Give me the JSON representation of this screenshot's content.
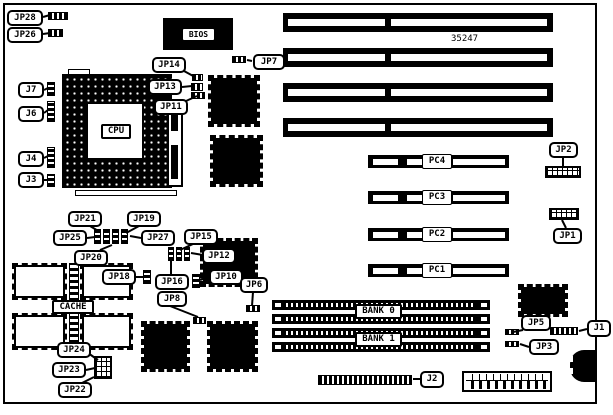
{
  "part_number": {
    "text": "35247"
  },
  "colors": {
    "ink": "#000000",
    "paper": "#ffffff"
  },
  "board": {
    "x": 3,
    "y": 3,
    "w": 594,
    "h": 401
  },
  "cpu": {
    "socket": {
      "x": 62,
      "y": 74,
      "w": 110,
      "h": 114
    },
    "inner": {
      "x": 86,
      "y": 102,
      "w": 58,
      "h": 58
    },
    "lever": {
      "x": 75,
      "y": 190,
      "w": 102,
      "h": 6
    },
    "notch": {
      "x": 68,
      "y": 69,
      "w": 22,
      "h": 6
    },
    "vreg": {
      "x": 167,
      "y": 103,
      "w": 16,
      "h": 84,
      "bar": {
        "x": 171,
        "y": 111,
        "w": 7,
        "h": 68
      },
      "gap": {
        "x": 171,
        "y": 131,
        "w": 7,
        "h": 14
      }
    }
  },
  "bios_chip": {
    "x": 163,
    "y": 18,
    "w": 70,
    "h": 32
  },
  "isa_slots": {
    "x": 283,
    "w": 270,
    "h": 19,
    "tops": [
      13,
      48,
      83,
      118
    ],
    "segs": [
      [
        5,
        97
      ],
      [
        108,
        156
      ]
    ],
    "segY": 6,
    "segH": 7
  },
  "pc_slots": {
    "x": 368,
    "w": 141,
    "h": 13,
    "items": [
      {
        "label": "PC4",
        "top": 155
      },
      {
        "label": "PC3",
        "top": 191
      },
      {
        "label": "PC2",
        "top": 228
      },
      {
        "label": "PC1",
        "top": 264
      }
    ],
    "segs": [
      [
        5,
        25
      ],
      [
        39,
        16
      ],
      [
        85,
        52
      ]
    ],
    "segY": 4,
    "segH": 6,
    "label_dx": 54,
    "label_w": 30,
    "label_h": 15
  },
  "simm_slots": {
    "x": 272,
    "w": 218,
    "h": 10,
    "tops": [
      300,
      314,
      328,
      342
    ]
  },
  "qfp_chips": [
    {
      "id": "qfp-chip-1",
      "x": 208,
      "y": 75,
      "w": 52,
      "h": 52
    },
    {
      "id": "qfp-chip-2",
      "x": 210,
      "y": 135,
      "w": 53,
      "h": 52
    },
    {
      "id": "qfp-chip-3",
      "x": 200,
      "y": 238,
      "w": 58,
      "h": 49
    },
    {
      "id": "qfp-chip-4",
      "x": 141,
      "y": 321,
      "w": 49,
      "h": 51
    },
    {
      "id": "qfp-chip-5",
      "x": 207,
      "y": 321,
      "w": 51,
      "h": 51
    },
    {
      "id": "qfp-chip-6",
      "x": 518,
      "y": 284,
      "w": 50,
      "h": 33
    }
  ],
  "cache": {
    "chips": [
      {
        "x": 12,
        "y": 263,
        "w": 55,
        "h": 37
      },
      {
        "x": 80,
        "y": 263,
        "w": 53,
        "h": 37
      },
      {
        "x": 12,
        "y": 313,
        "w": 55,
        "h": 37
      },
      {
        "x": 80,
        "y": 313,
        "w": 53,
        "h": 37
      }
    ],
    "pack": {
      "x": 69,
      "y": 263,
      "w": 10,
      "h": 87
    }
  },
  "power_connector": {
    "x": 462,
    "y": 371,
    "w": 90,
    "h": 21
  },
  "keyboard_connector": {
    "x": 570,
    "y": 350,
    "w": 27,
    "h": 32,
    "notches": [
      [
        568,
        356,
        5,
        6
      ],
      [
        568,
        368,
        5,
        6
      ]
    ]
  },
  "connectors": [
    {
      "id": "jp28-connector",
      "x": 48,
      "y": 12,
      "w": 20,
      "h": 8,
      "type": "h"
    },
    {
      "id": "jp26-connector",
      "x": 48,
      "y": 29,
      "w": 15,
      "h": 8,
      "type": "h"
    },
    {
      "id": "j7-connector",
      "x": 47,
      "y": 82,
      "w": 8,
      "h": 14,
      "type": "v"
    },
    {
      "id": "j6-connector",
      "x": 47,
      "y": 101,
      "w": 8,
      "h": 21,
      "type": "v"
    },
    {
      "id": "j4-connector",
      "x": 47,
      "y": 147,
      "w": 8,
      "h": 21,
      "type": "v"
    },
    {
      "id": "j3-connector",
      "x": 47,
      "y": 174,
      "w": 8,
      "h": 13,
      "type": "v"
    },
    {
      "id": "jp14-jumper",
      "x": 192,
      "y": 74,
      "w": 11,
      "h": 7,
      "type": "h"
    },
    {
      "id": "jp13-jumper",
      "x": 191,
      "y": 83,
      "w": 12,
      "h": 8,
      "type": "h"
    },
    {
      "id": "jp11-jumper",
      "x": 191,
      "y": 92,
      "w": 14,
      "h": 7,
      "type": "h"
    },
    {
      "id": "jp7-connector",
      "x": 232,
      "y": 56,
      "w": 14,
      "h": 7,
      "type": "h"
    },
    {
      "id": "jumper-cluster-a1",
      "x": 94,
      "y": 229,
      "w": 7,
      "h": 15,
      "type": "v"
    },
    {
      "id": "jumper-cluster-a2",
      "x": 103,
      "y": 229,
      "w": 7,
      "h": 15,
      "type": "v"
    },
    {
      "id": "jumper-cluster-a3",
      "x": 112,
      "y": 229,
      "w": 7,
      "h": 15,
      "type": "v"
    },
    {
      "id": "jumper-cluster-a4",
      "x": 121,
      "y": 229,
      "w": 7,
      "h": 15,
      "type": "v"
    },
    {
      "id": "jumper-cluster-b1",
      "x": 168,
      "y": 247,
      "w": 6,
      "h": 14,
      "type": "v"
    },
    {
      "id": "jumper-cluster-b2",
      "x": 176,
      "y": 247,
      "w": 6,
      "h": 14,
      "type": "v"
    },
    {
      "id": "jumper-cluster-b3",
      "x": 184,
      "y": 247,
      "w": 6,
      "h": 14,
      "type": "v"
    },
    {
      "id": "jp18-jumper",
      "x": 143,
      "y": 270,
      "w": 8,
      "h": 14,
      "type": "v"
    },
    {
      "id": "jp10-jumper",
      "x": 192,
      "y": 274,
      "w": 8,
      "h": 14,
      "type": "v"
    },
    {
      "id": "jp8-jumper",
      "x": 193,
      "y": 317,
      "w": 13,
      "h": 7,
      "type": "h"
    },
    {
      "id": "jp6-jumper",
      "x": 246,
      "y": 305,
      "w": 14,
      "h": 7,
      "type": "h"
    },
    {
      "id": "jp22-jp23-jumper-block",
      "x": 94,
      "y": 356,
      "w": 18,
      "h": 23,
      "type": "grid"
    },
    {
      "id": "jp2-connector",
      "x": 545,
      "y": 166,
      "w": 36,
      "h": 12,
      "type": "grid"
    },
    {
      "id": "jp1-connector",
      "x": 549,
      "y": 208,
      "w": 30,
      "h": 12,
      "type": "grid"
    },
    {
      "id": "jp5-jumper",
      "x": 505,
      "y": 329,
      "w": 14,
      "h": 6,
      "type": "h"
    },
    {
      "id": "jp3-jumper",
      "x": 505,
      "y": 341,
      "w": 14,
      "h": 6,
      "type": "h"
    },
    {
      "id": "j1-connector",
      "x": 550,
      "y": 327,
      "w": 28,
      "h": 8,
      "type": "h"
    },
    {
      "id": "j2-connector",
      "x": 318,
      "y": 375,
      "w": 94,
      "h": 10,
      "type": "h"
    }
  ],
  "labels": [
    {
      "id": "jp28",
      "text": "JP28",
      "x": 7,
      "y": 10,
      "w": 36,
      "h": 16
    },
    {
      "id": "jp26",
      "text": "JP26",
      "x": 7,
      "y": 27,
      "w": 36,
      "h": 16
    },
    {
      "id": "j7",
      "text": "J7",
      "x": 18,
      "y": 82,
      "w": 26,
      "h": 16
    },
    {
      "id": "j6",
      "text": "J6",
      "x": 18,
      "y": 106,
      "w": 26,
      "h": 16
    },
    {
      "id": "j4",
      "text": "J4",
      "x": 18,
      "y": 151,
      "w": 26,
      "h": 16
    },
    {
      "id": "j3",
      "text": "J3",
      "x": 18,
      "y": 172,
      "w": 26,
      "h": 16
    },
    {
      "id": "jp14",
      "text": "JP14",
      "x": 152,
      "y": 57,
      "w": 34,
      "h": 16
    },
    {
      "id": "jp13",
      "text": "JP13",
      "x": 148,
      "y": 79,
      "w": 34,
      "h": 16
    },
    {
      "id": "jp11",
      "text": "JP11",
      "x": 154,
      "y": 99,
      "w": 34,
      "h": 16
    },
    {
      "id": "jp7",
      "text": "JP7",
      "x": 253,
      "y": 54,
      "w": 32,
      "h": 16
    },
    {
      "id": "jp21",
      "text": "JP21",
      "x": 68,
      "y": 211,
      "w": 34,
      "h": 16
    },
    {
      "id": "jp19",
      "text": "JP19",
      "x": 127,
      "y": 211,
      "w": 34,
      "h": 16
    },
    {
      "id": "jp25",
      "text": "JP25",
      "x": 53,
      "y": 230,
      "w": 34,
      "h": 16
    },
    {
      "id": "jp27",
      "text": "JP27",
      "x": 141,
      "y": 230,
      "w": 34,
      "h": 16
    },
    {
      "id": "jp20",
      "text": "JP20",
      "x": 74,
      "y": 250,
      "w": 34,
      "h": 16
    },
    {
      "id": "jp15",
      "text": "JP15",
      "x": 184,
      "y": 229,
      "w": 34,
      "h": 16
    },
    {
      "id": "jp12",
      "text": "JP12",
      "x": 202,
      "y": 248,
      "w": 34,
      "h": 16
    },
    {
      "id": "jp18",
      "text": "JP18",
      "x": 102,
      "y": 269,
      "w": 34,
      "h": 16
    },
    {
      "id": "jp16",
      "text": "JP16",
      "x": 155,
      "y": 274,
      "w": 34,
      "h": 16
    },
    {
      "id": "jp10",
      "text": "JP10",
      "x": 209,
      "y": 269,
      "w": 34,
      "h": 16
    },
    {
      "id": "jp8",
      "text": "JP8",
      "x": 157,
      "y": 291,
      "w": 30,
      "h": 16
    },
    {
      "id": "jp6",
      "text": "JP6",
      "x": 240,
      "y": 277,
      "w": 28,
      "h": 16
    },
    {
      "id": "cache",
      "text": "CACHE",
      "x": 52,
      "y": 300,
      "w": 42,
      "h": 14,
      "cls": "sq"
    },
    {
      "id": "jp24",
      "text": "JP24",
      "x": 57,
      "y": 342,
      "w": 34,
      "h": 16
    },
    {
      "id": "jp23",
      "text": "JP23",
      "x": 52,
      "y": 362,
      "w": 34,
      "h": 16
    },
    {
      "id": "jp22",
      "text": "JP22",
      "x": 58,
      "y": 382,
      "w": 34,
      "h": 16
    },
    {
      "id": "bank0",
      "text": "BANK 0",
      "x": 355,
      "y": 304,
      "w": 47,
      "h": 15,
      "cls": "sq"
    },
    {
      "id": "bank1",
      "text": "BANK 1",
      "x": 355,
      "y": 332,
      "w": 47,
      "h": 15,
      "cls": "sq"
    },
    {
      "id": "jp2",
      "text": "JP2",
      "x": 549,
      "y": 142,
      "w": 29,
      "h": 16
    },
    {
      "id": "jp1",
      "text": "JP1",
      "x": 553,
      "y": 228,
      "w": 29,
      "h": 16
    },
    {
      "id": "jp5",
      "text": "JP5",
      "x": 521,
      "y": 315,
      "w": 30,
      "h": 16
    },
    {
      "id": "jp3",
      "text": "JP3",
      "x": 529,
      "y": 339,
      "w": 30,
      "h": 16
    },
    {
      "id": "j1",
      "text": "J1",
      "x": 587,
      "y": 320,
      "w": 24,
      "h": 17
    },
    {
      "id": "j2",
      "text": "J2",
      "x": 420,
      "y": 371,
      "w": 24,
      "h": 17
    },
    {
      "id": "bios",
      "text": "BIOS",
      "x": 182,
      "y": 28,
      "w": 33,
      "h": 13,
      "cls": "sq thin",
      "fs": 8
    },
    {
      "id": "cpu",
      "text": "CPU",
      "x": 101,
      "y": 124,
      "w": 30,
      "h": 15,
      "cls": "sq"
    }
  ],
  "leaders": [
    [
      43,
      17,
      50,
      15
    ],
    [
      43,
      34,
      50,
      33
    ],
    [
      44,
      90,
      48,
      88
    ],
    [
      44,
      113,
      48,
      110
    ],
    [
      44,
      158,
      48,
      156
    ],
    [
      44,
      180,
      48,
      180
    ],
    [
      184,
      71,
      195,
      77
    ],
    [
      182,
      87,
      192,
      86
    ],
    [
      186,
      101,
      197,
      96
    ],
    [
      252,
      61,
      247,
      60
    ],
    [
      90,
      226,
      100,
      232
    ],
    [
      139,
      226,
      126,
      233
    ],
    [
      87,
      238,
      95,
      237
    ],
    [
      141,
      238,
      130,
      236
    ],
    [
      100,
      250,
      112,
      245
    ],
    [
      193,
      244,
      180,
      250
    ],
    [
      203,
      255,
      191,
      253
    ],
    [
      171,
      274,
      171,
      261
    ],
    [
      136,
      277,
      144,
      277
    ],
    [
      209,
      277,
      200,
      280
    ],
    [
      170,
      306,
      198,
      317
    ],
    [
      253,
      292,
      252,
      306
    ],
    [
      88,
      353,
      98,
      360
    ],
    [
      86,
      370,
      95,
      368
    ],
    [
      80,
      384,
      94,
      377
    ],
    [
      563,
      157,
      563,
      167
    ],
    [
      566,
      228,
      562,
      220
    ],
    [
      523,
      330,
      513,
      332
    ],
    [
      529,
      347,
      520,
      344
    ],
    [
      587,
      329,
      579,
      331
    ],
    [
      420,
      379,
      413,
      379
    ]
  ]
}
